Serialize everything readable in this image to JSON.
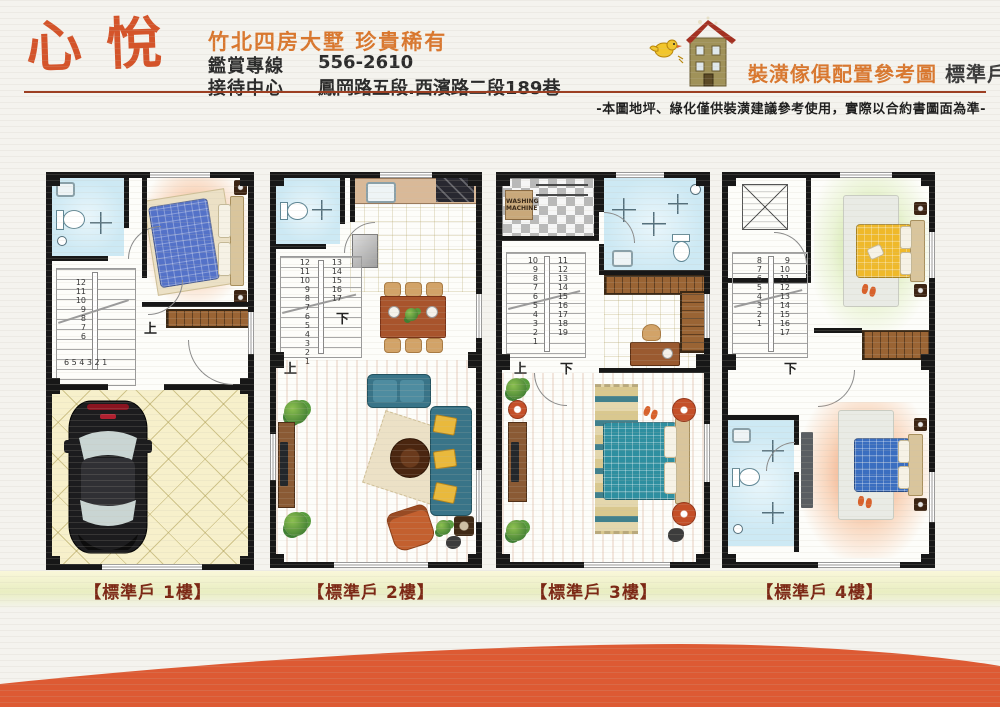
{
  "header": {
    "logo": "心悅",
    "tagline": "竹北四房大墅 珍貴稀有",
    "hotline_label": "鑑賞專線",
    "hotline_number": "556-2610",
    "center_label": "接待中心",
    "center_address": "鳳岡路五段.西濱路二段189巷",
    "plan_title": "裝潢傢俱配置參考圖",
    "plan_unit": "標準戶",
    "disclaimer": "-本圖地坪、綠化僅供裝潢建議參考使用，實際以合約書圖面為準-"
  },
  "colors": {
    "accent_orange": "#d4542a",
    "title_orange": "#d9772e",
    "wave_orange": "#dd5a33",
    "caption_text": "#7c2815"
  },
  "floors": [
    {
      "caption": "【標準戶 1樓】",
      "up_label": "上",
      "stairs_col1": "12\n11\n10\n9\n8\n7\n6",
      "stairs_row": "6 5 4 3 2 1"
    },
    {
      "caption": "【標準戶 2樓】",
      "up_label": "上",
      "down_label": "下",
      "stairs_col1": "12\n11\n10\n9\n8\n7\n6\n5\n4\n3\n2\n1",
      "stairs_col2": "13\n14\n15\n16\n17"
    },
    {
      "caption": "【標準戶 3樓】",
      "up_label": "上",
      "down_label": "下",
      "stairs_col1": "10\n9\n8\n7\n6\n5\n4\n3\n2\n1",
      "stairs_col2": "11\n12\n13\n14\n15\n16\n17\n18\n19",
      "washer_label": "WASHING MACHINE"
    },
    {
      "caption": "【標準戶 4樓】",
      "down_label": "下",
      "stairs_col1": "8\n7\n6\n5\n4\n3\n2\n1",
      "stairs_col2": "9\n10\n11\n12\n13\n14\n15\n16\n17"
    }
  ]
}
